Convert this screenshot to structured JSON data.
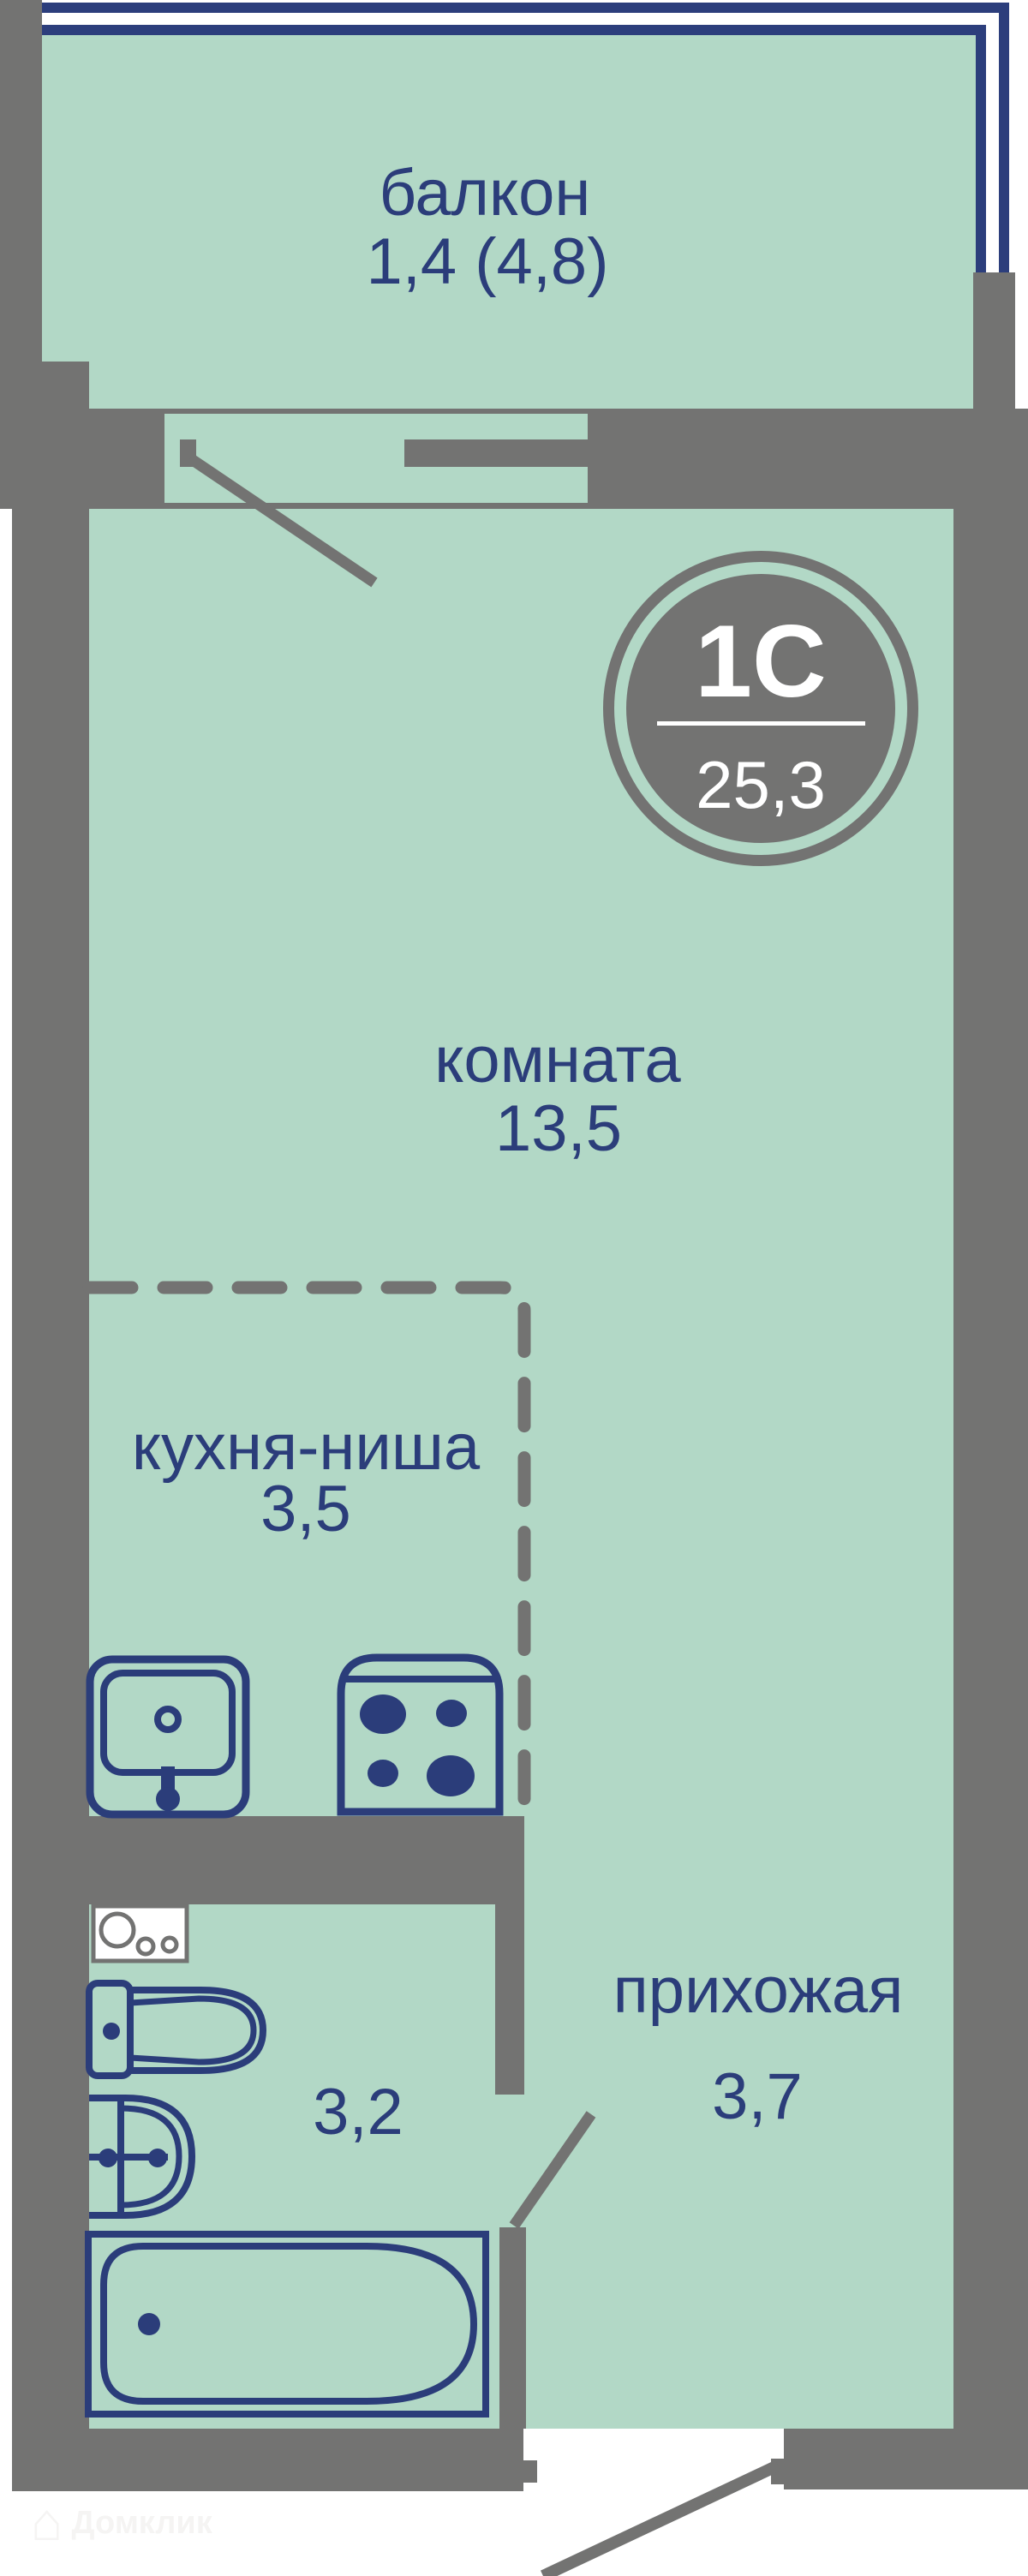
{
  "plan": {
    "badge": {
      "type_label": "1С",
      "total_area": "25,3"
    },
    "rooms": {
      "balcony": {
        "label": "балкон",
        "area": "1,4 (4,8)"
      },
      "living": {
        "label": "комната",
        "area": "13,5"
      },
      "kitchen": {
        "label": "кухня-ниша",
        "area": "3,5"
      },
      "hallway": {
        "label": "прихожая",
        "area": "3,7"
      },
      "bathroom": {
        "area": "3,2"
      }
    },
    "watermark": {
      "brand": "Домклик",
      "house_glyph": "⌂"
    },
    "colors": {
      "wall_gray": "#737372",
      "floor_green": "#b2d8c6",
      "accent_navy": "#2b3d7a",
      "railing_navy": "#2c3e7c",
      "watermark_gray": "#f5f4f3",
      "background": "#ffffff"
    }
  }
}
